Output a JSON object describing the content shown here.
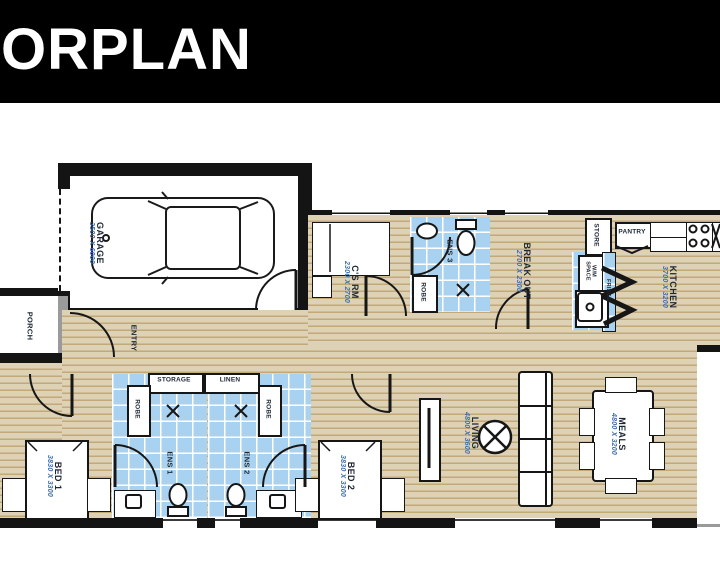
{
  "header": {
    "title": "ORPLAN"
  },
  "plan": {
    "rooms": [
      {
        "id": "garage",
        "name": "GARAGE",
        "dim": "3500 X 6000"
      },
      {
        "id": "porch",
        "name": "PORCH"
      },
      {
        "id": "entry",
        "name": "ENTRY"
      },
      {
        "id": "cs_rm",
        "name": "C'S RM",
        "dim": "2300 X 2700"
      },
      {
        "id": "ens3",
        "name": "ENS 3"
      },
      {
        "id": "breakout",
        "name": "BREAK OUT",
        "dim": "2700 X 2300"
      },
      {
        "id": "kitchen",
        "name": "KITCHEN",
        "dim": "3700 X 3200"
      },
      {
        "id": "bed1",
        "name": "BED 1",
        "dim": "3830 X 3300"
      },
      {
        "id": "ens1",
        "name": "ENS 1"
      },
      {
        "id": "ens2",
        "name": "ENS 2"
      },
      {
        "id": "bed2",
        "name": "BED 2",
        "dim": "3830 X 3300"
      },
      {
        "id": "living",
        "name": "LIVING",
        "dim": "4800 X 3600"
      },
      {
        "id": "meals",
        "name": "MEALS",
        "dim": "4800 X 3200"
      }
    ],
    "closets": {
      "store": "STORE",
      "pantry": "PANTRY",
      "wm_space": "W/M SPACE",
      "fridge": "FRIDGE",
      "storage": "STORAGE",
      "linen": "LINEN",
      "robe": "ROBE"
    }
  },
  "palette": {
    "wall": "#141414",
    "floor_base": "#ddd2b5",
    "floor_stripe": "#c3a878",
    "tile_blue": "#a8d2f0",
    "room_name": "#1d2734",
    "dimension": "#3e6dac",
    "header_bg": "#000000",
    "header_text": "#ffffff"
  }
}
